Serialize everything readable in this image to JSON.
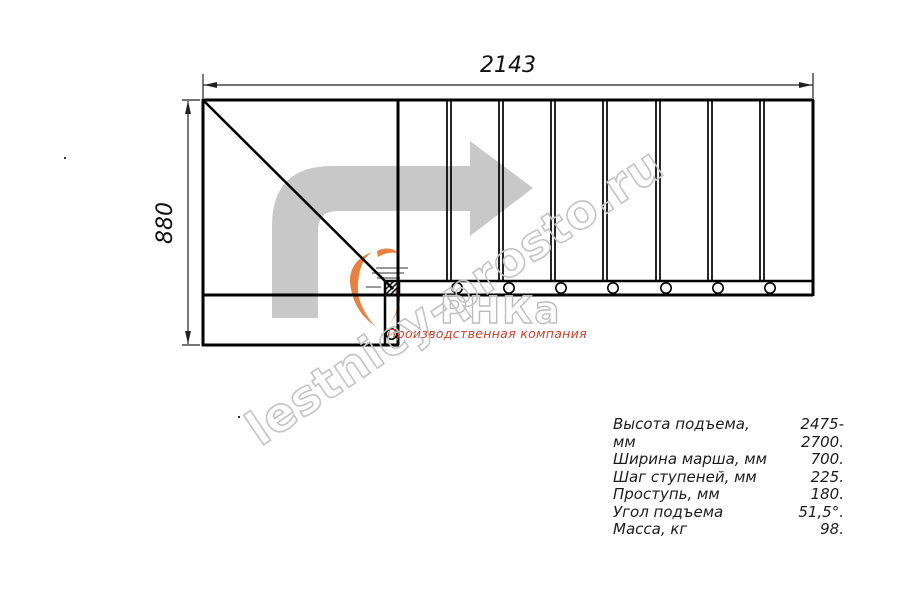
{
  "drawing": {
    "dim_width_label": "2143",
    "dim_height_label": "880"
  },
  "watermark": {
    "domain_text": "lestnicy-prosto.ru",
    "logo_text": "РНКа",
    "logo_subtitle": "Производственная компания"
  },
  "specs": {
    "rows": [
      {
        "label": "Высота подъема, мм",
        "value": "2475-2700."
      },
      {
        "label": "Ширина марша, мм",
        "value": "700."
      },
      {
        "label": "Шаг ступеней, мм",
        "value": "225."
      },
      {
        "label": "Проступь, мм",
        "value": "180."
      },
      {
        "label": "Угол подъема",
        "value": "51,5°."
      },
      {
        "label": "Масса, кг",
        "value": "98."
      }
    ]
  },
  "colors": {
    "line_black": "#000000",
    "dimension_gray": "#222222",
    "arrow_gray": "#c8c8c8",
    "watermark_gray": "#c4c4c4",
    "logo_gray": "#bdbdbd",
    "subtitle_red": "#c8432f",
    "swoosh_orange": "#e9803f"
  }
}
